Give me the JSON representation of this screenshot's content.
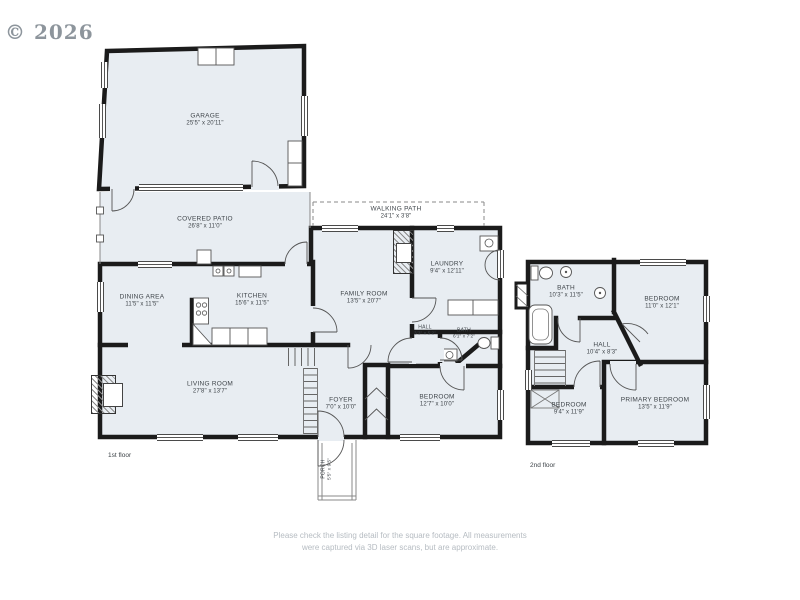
{
  "watermark": "© 2026",
  "disclaimer": {
    "line1": "Please check the listing detail for the square footage. All measurements",
    "line2": "were captured via 3D laser scans, but are approximate."
  },
  "floor1": {
    "label": "1st floor",
    "rooms": {
      "garage": {
        "name": "GARAGE",
        "dims": "25'5\" x 20'11\""
      },
      "covered_patio": {
        "name": "COVERED PATIO",
        "dims": "26'8\" x 11'0\""
      },
      "walking_path": {
        "name": "WALKING PATH",
        "dims": "24'1\" x 3'8\""
      },
      "family_room": {
        "name": "FAMILY ROOM",
        "dims": "13'5\" x 20'7\""
      },
      "laundry": {
        "name": "LAUNDRY",
        "dims": "9'4\" x 12'11\""
      },
      "dining_area": {
        "name": "DINING AREA",
        "dims": "11'5\" x 11'5\""
      },
      "kitchen": {
        "name": "KITCHEN",
        "dims": "15'6\" x 11'5\""
      },
      "hall": {
        "name": "HALL",
        "dims": "3'3\" x 5'2\""
      },
      "bath": {
        "name": "BATH",
        "dims": "6'1\" x 7'2\""
      },
      "living_room": {
        "name": "LIVING ROOM",
        "dims": "27'8\" x 13'7\""
      },
      "foyer": {
        "name": "FOYER",
        "dims": "7'0\" x 10'0\""
      },
      "bedroom": {
        "name": "BEDROOM",
        "dims": "12'7\" x 10'0\""
      },
      "porch": {
        "name": "PORCH",
        "dims": "5'5\" x 9'5\""
      }
    }
  },
  "floor2": {
    "label": "2nd floor",
    "rooms": {
      "bath": {
        "name": "BATH",
        "dims": "10'3\" x 11'5\""
      },
      "bedroom_upper": {
        "name": "BEDROOM",
        "dims": "11'0\" x 12'1\""
      },
      "hall": {
        "name": "HALL",
        "dims": "10'4\" x 8'3\""
      },
      "bedroom_lower": {
        "name": "BEDROOM",
        "dims": "9'4\" x 11'9\""
      },
      "primary_bedroom": {
        "name": "PRIMARY BEDROOM",
        "dims": "13'5\" x 11'9\""
      }
    }
  }
}
